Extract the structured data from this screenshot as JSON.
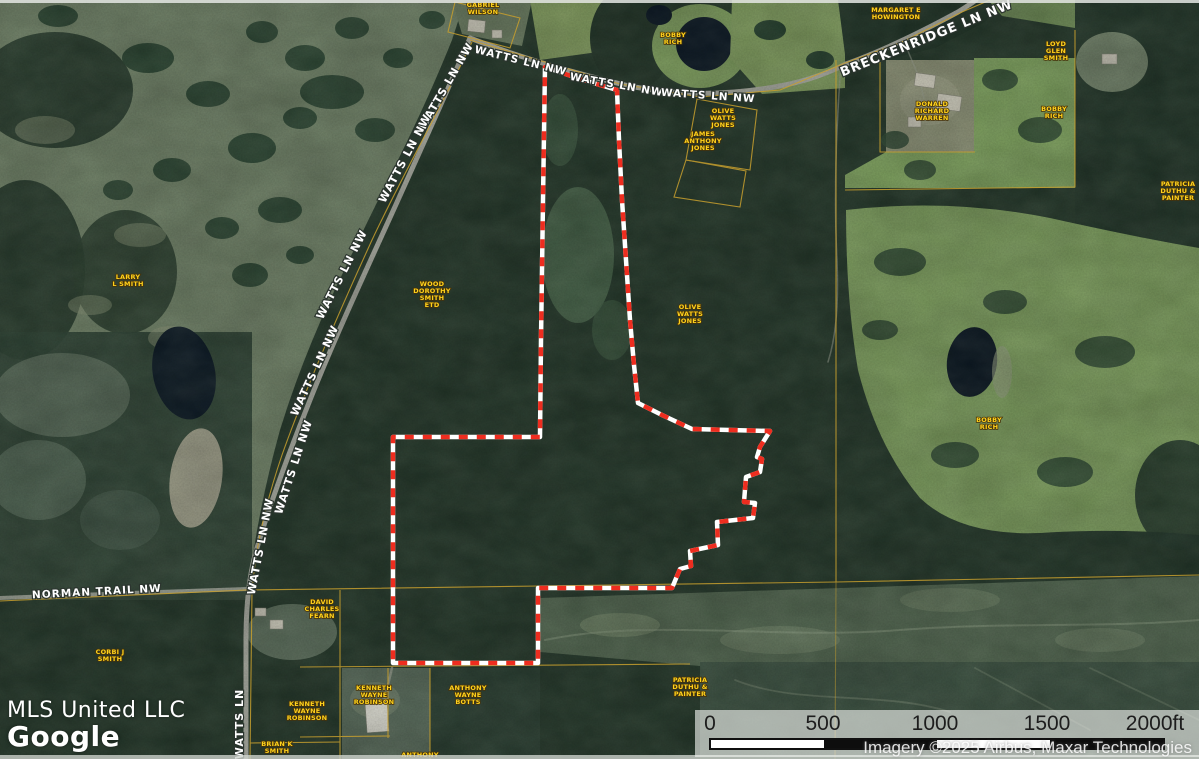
{
  "map": {
    "watermark": "MLS United LLC",
    "logo": "Google",
    "attribution": "Imagery ©2025 Airbus, Maxar Technologies",
    "colors": {
      "boundary_red": "#ee2d1f",
      "boundary_casing": "#ffffff",
      "parcel_line_yellow": "#c79f2e",
      "owner_label_yellow": "#ffd21c",
      "road_label_white": "#ffffff"
    },
    "scale_bar": {
      "ticks": [
        "0",
        "500",
        "1000",
        "1500",
        "2000ft"
      ]
    },
    "road_labels": [
      {
        "text": "WATTS LN NW",
        "x": 520,
        "y": 64,
        "rot": 14,
        "size": 10.5
      },
      {
        "text": "WATTS LN NW",
        "x": 616,
        "y": 88,
        "rot": 10,
        "size": 10.5
      },
      {
        "text": "WATTS LN NW",
        "x": 708,
        "y": 99,
        "rot": 4,
        "size": 10.5
      },
      {
        "text": "WATTS LN NW",
        "x": 449,
        "y": 88,
        "rot": -60,
        "size": 11
      },
      {
        "text": "WATTS LN NW",
        "x": 408,
        "y": 160,
        "rot": -62,
        "size": 11
      },
      {
        "text": "WATTS LN NW",
        "x": 345,
        "y": 276,
        "rot": -63,
        "size": 11
      },
      {
        "text": "WATTS LN NW",
        "x": 318,
        "y": 372,
        "rot": -65,
        "size": 11
      },
      {
        "text": "WATTS LN NW",
        "x": 297,
        "y": 468,
        "rot": -72,
        "size": 11
      },
      {
        "text": "WATTS LN NW",
        "x": 264,
        "y": 547,
        "rot": -79,
        "size": 11
      },
      {
        "text": "WATTS LN",
        "x": 243,
        "y": 724,
        "rot": -90,
        "size": 11
      },
      {
        "text": "BRECKENRIDGE LN NW",
        "x": 928,
        "y": 42,
        "rot": -22,
        "size": 13
      },
      {
        "text": "NORMAN TRAIL NW",
        "x": 97,
        "y": 595,
        "rot": -3,
        "size": 10.5
      }
    ],
    "owner_labels": [
      {
        "lines": [
          "GABRIEL",
          "WILSON"
        ],
        "x": 483,
        "y": 7
      },
      {
        "lines": [
          "MARGARET E",
          "HOWINGTON"
        ],
        "x": 896,
        "y": 12
      },
      {
        "lines": [
          "BOBBY",
          "RICH"
        ],
        "x": 673,
        "y": 37
      },
      {
        "lines": [
          "LOYD",
          "GLEN",
          "SMITH"
        ],
        "x": 1056,
        "y": 46
      },
      {
        "lines": [
          "DONALD",
          "RICHARD",
          "WARREN"
        ],
        "x": 932,
        "y": 106
      },
      {
        "lines": [
          "BOBBY",
          "RICH"
        ],
        "x": 1054,
        "y": 111
      },
      {
        "lines": [
          "OLIVE",
          "WATTS",
          "JONES"
        ],
        "x": 723,
        "y": 113
      },
      {
        "lines": [
          "JAMES",
          "ANTHONY",
          "JONES"
        ],
        "x": 703,
        "y": 136
      },
      {
        "lines": [
          "PATRICIA",
          "DUTHU &",
          "PAINTER"
        ],
        "x": 1178,
        "y": 186
      },
      {
        "lines": [
          "LARRY",
          "L SMITH"
        ],
        "x": 128,
        "y": 279
      },
      {
        "lines": [
          "WOOD",
          "DOROTHY",
          "SMITH",
          "ETD"
        ],
        "x": 432,
        "y": 286
      },
      {
        "lines": [
          "OLIVE",
          "WATTS",
          "JONES"
        ],
        "x": 690,
        "y": 309
      },
      {
        "lines": [
          "BOBBY",
          "RICH"
        ],
        "x": 989,
        "y": 422
      },
      {
        "lines": [
          "CORBI J",
          "SMITH"
        ],
        "x": 110,
        "y": 654
      },
      {
        "lines": [
          "DAVID",
          "CHARLES",
          "FEARN"
        ],
        "x": 322,
        "y": 604
      },
      {
        "lines": [
          "KENNETH",
          "WAYNE",
          "ROBINSON"
        ],
        "x": 307,
        "y": 706
      },
      {
        "lines": [
          "KENNETH",
          "WAYNE",
          "ROBINSON"
        ],
        "x": 374,
        "y": 690
      },
      {
        "lines": [
          "ANTHONY",
          "WAYNE",
          "BOTTS"
        ],
        "x": 468,
        "y": 690
      },
      {
        "lines": [
          "PATRICIA",
          "DUTHU &",
          "PAINTER"
        ],
        "x": 690,
        "y": 682
      },
      {
        "lines": [
          "BRIAN K",
          "SMITH"
        ],
        "x": 277,
        "y": 746
      },
      {
        "lines": [
          "ANTHONY"
        ],
        "x": 420,
        "y": 757
      }
    ],
    "boundary": {
      "color": "#ee2d1f",
      "casing": "#ffffff",
      "points": [
        [
          545,
          67
        ],
        [
          580,
          79
        ],
        [
          617,
          90
        ],
        [
          619,
          140
        ],
        [
          622,
          200
        ],
        [
          626,
          260
        ],
        [
          630,
          320
        ],
        [
          634,
          365
        ],
        [
          638,
          403
        ],
        [
          662,
          415
        ],
        [
          692,
          429
        ],
        [
          770,
          431
        ],
        [
          760,
          447
        ],
        [
          757,
          457
        ],
        [
          762,
          459
        ],
        [
          760,
          472
        ],
        [
          746,
          477
        ],
        [
          744,
          502
        ],
        [
          755,
          503
        ],
        [
          753,
          518
        ],
        [
          717,
          522
        ],
        [
          718,
          545
        ],
        [
          690,
          551
        ],
        [
          691,
          566
        ],
        [
          680,
          569
        ],
        [
          672,
          588
        ],
        [
          538,
          588
        ],
        [
          538,
          663
        ],
        [
          393,
          663
        ],
        [
          393,
          437
        ],
        [
          540,
          437
        ],
        [
          541,
          340
        ],
        [
          543,
          200
        ]
      ]
    }
  }
}
